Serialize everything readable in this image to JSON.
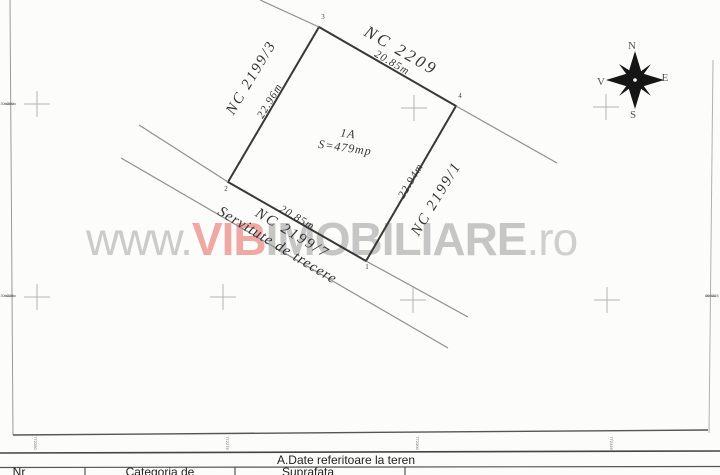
{
  "watermark": {
    "www": "www.",
    "vib": "VIB",
    "imobiliare": "IMOBILIARE",
    "ro": ".ro",
    "vib_color": "#f0a8a4",
    "gray_color": "#c6c6c6"
  },
  "parcel": {
    "id": "1A",
    "area": "S=479mp"
  },
  "labels": {
    "nc_top": "NC 2209",
    "nc_left": "NC 2199/3",
    "nc_right": "NC 2199/1",
    "nc_strip": "NC 2199/7",
    "len_top": "20.85m",
    "len_left": "22.96m",
    "len_right": "22.94m",
    "len_bottom": "20.85m",
    "easement": "Servitute de trecere"
  },
  "vertices": {
    "v1": "1",
    "v2": "2",
    "v3": "3",
    "v4": "4"
  },
  "compass": {
    "north": "N",
    "east": "E",
    "south": "S",
    "west": "V"
  },
  "grid": {
    "left_tick_top": "304250",
    "left_tick_bottom": "304225",
    "right_tick": "304225",
    "bottom_tick_1": "772250",
    "bottom_tick_2": "772275",
    "bottom_tick_3": "772300",
    "bottom_tick_4": "772325"
  },
  "table": {
    "section_title": "A.Date referitoare la teren",
    "col_nr": "Nr",
    "col_categoria": "Categoria de",
    "col_suprafata": "Suprafata"
  }
}
